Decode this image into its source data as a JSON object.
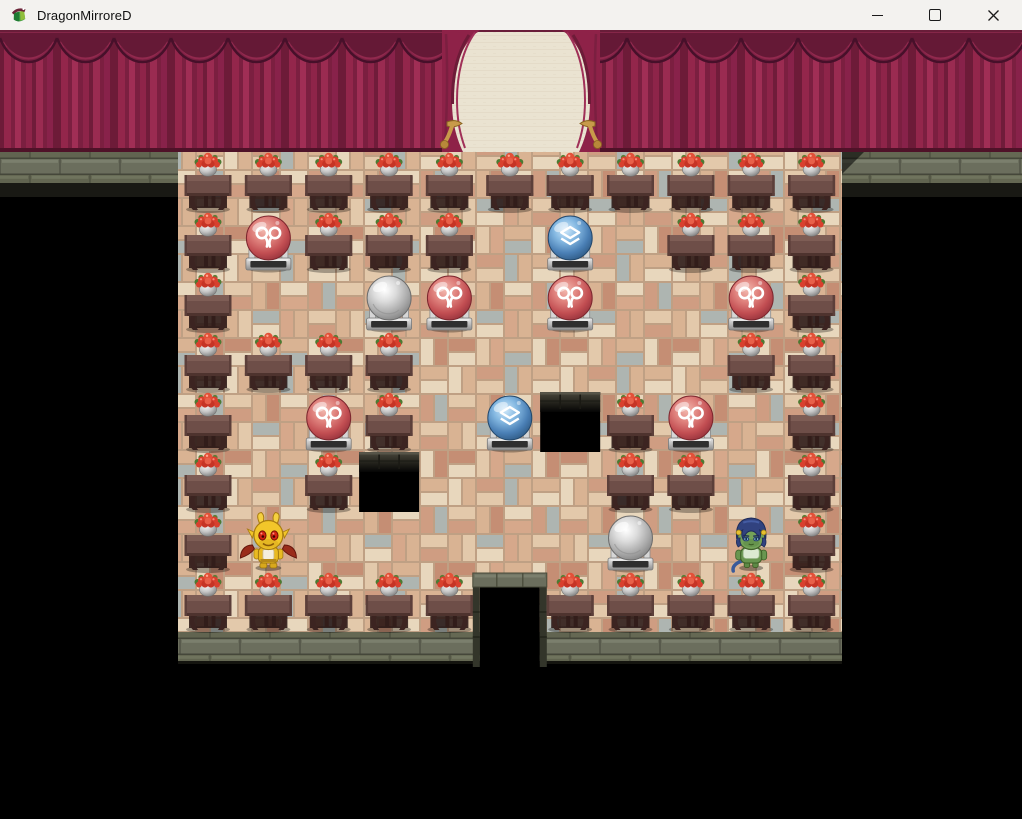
{
  "window": {
    "title": "DragonMirroreD",
    "controls": [
      {
        "name": "minimize",
        "icon": "minimize-icon"
      },
      {
        "name": "maximize",
        "icon": "maximize-icon"
      },
      {
        "name": "close",
        "icon": "close-icon"
      }
    ]
  },
  "game": {
    "scene": "theater-stage-room",
    "colors": {
      "curtain": "#8e2248",
      "curtain_shadow": "#5e1732",
      "stage_wall": "#eae3d1",
      "stage_floor_wood": "#8a6a22",
      "floor_brick_tan": "#d9b393",
      "floor_brick_gray": "#aeb5b1",
      "stone_wall": "#6b6e5d",
      "orb_red": "#c24e52",
      "orb_blue": "#4a7fb5",
      "orb_silver": "#ababab",
      "character_yellow": "#f2c62a",
      "character_green": "#74a258",
      "pit": "#000000"
    },
    "grid": {
      "cols": 11,
      "rows": 8,
      "tile_w": 60.36,
      "tile_h": 60,
      "origin_x": 178,
      "origin_y": 122
    },
    "legend": {
      "T": "table-with-flowers",
      "R": "red-heart-orb",
      "B": "blue-orb",
      "S": "silver-orb",
      "P": "floor-pit",
      "Y": "yellow-demon-character",
      "G": "green-goblin-character",
      "D": "south-doorway",
      ".": "floor"
    },
    "interactables": [
      "R",
      "B",
      "S",
      "Y",
      "G",
      "D"
    ],
    "map": [
      "TTTTTTTTTTT",
      "TRTTT.B.TTT",
      "T..SR.R..RT",
      "TTTT.....TT",
      "T.RT.BPTR.T",
      "T.TP...TT.T",
      "TY.....S.GT",
      "TTTTTDTTTTT"
    ]
  }
}
